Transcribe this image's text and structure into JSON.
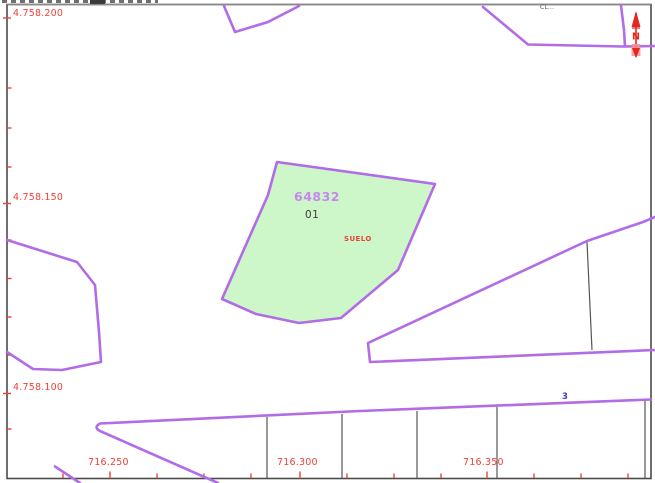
{
  "map": {
    "viewer": "cadastral-map",
    "north_label": "N",
    "street_name_fragment": "CL...",
    "street_number": "3",
    "parcel": {
      "code": "64832",
      "subparcel": "01",
      "land_use": "SUELO"
    },
    "y_axis": {
      "labels": [
        "4.758.200",
        "4.758.150",
        "4.758.100"
      ]
    },
    "x_axis": {
      "labels": [
        "716.250",
        "716.300",
        "716.350"
      ]
    }
  },
  "icons": [
    "north-arrow-icon"
  ],
  "colors": {
    "parcel_line": "#b16ce6",
    "parcel_fill": "#cdf6c9",
    "coordinate_text": "#ef4136",
    "parcel_code_text": "#c887f0",
    "subparcel_text": "#3d3d3d",
    "land_use_text": "#ef4136",
    "north_arrow": "#e02820",
    "street_number_text": "#3838d8",
    "map_border": "#4b4b4b"
  }
}
